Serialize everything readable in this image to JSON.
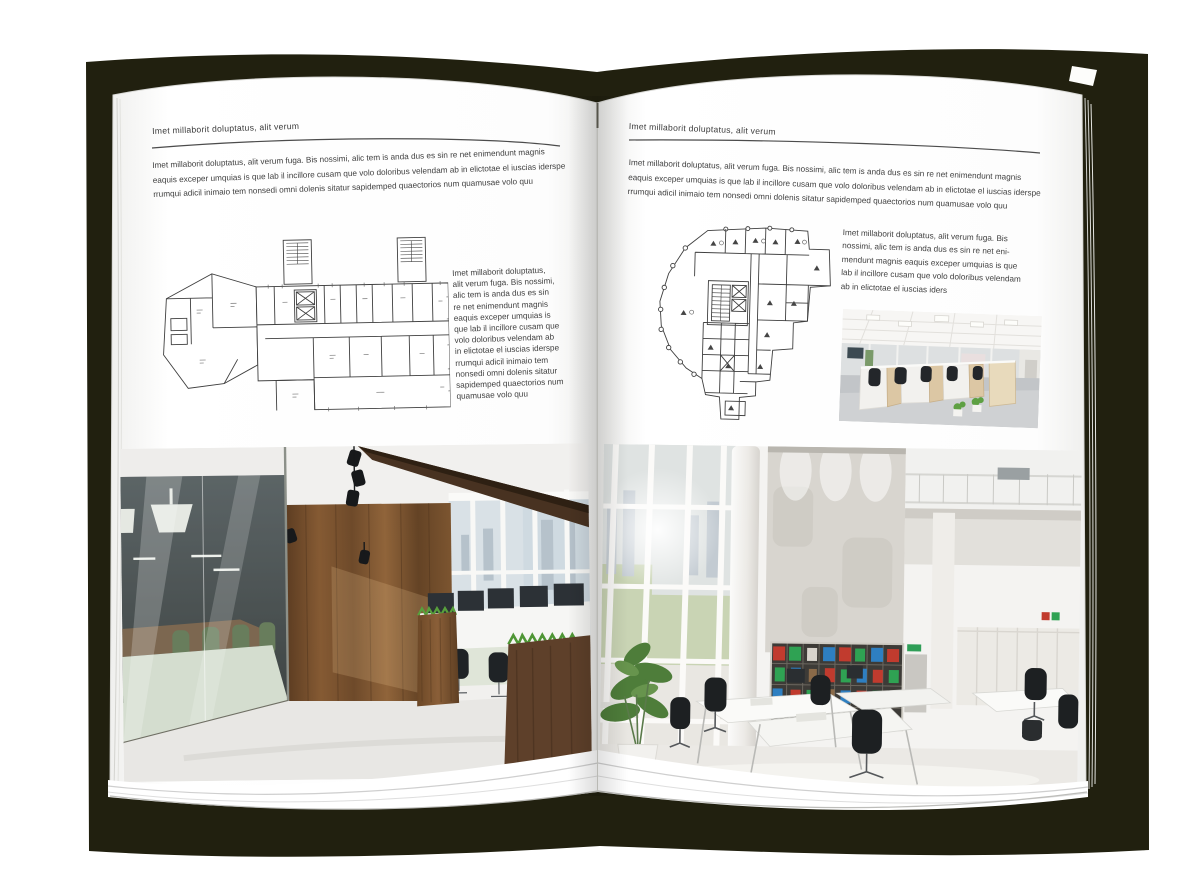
{
  "book": {
    "cover_color": "#21200f",
    "page_color": "#ffffff",
    "text_color": "#3f3f3f"
  },
  "left_page": {
    "header": "Imet millaborit doluptatus, alit verum",
    "intro_lines": [
      "Imet millaborit doluptatus, alit verum fuga. Bis nossimi, alic tem is anda dus es sin re net enimendunt magnis",
      "eaquis exceper umquias is que lab il incillore cusam que volo doloribus velendam ab in elictotae el iuscias iderspe",
      "rrumqui adicil inimaio tem nonsedi omni dolenis sitatur sapidemped quaectorios num quamusae volo quu"
    ],
    "side_lines": [
      "Imet millaborit doluptatus,",
      "alit verum fuga. Bis nossimi,",
      "alic tem is anda dus es sin",
      "re net enimendunt magnis",
      "eaquis exceper umquias is",
      "que lab il incillore cusam que",
      "volo doloribus velendam ab",
      "in elictotae el iuscias iderspe",
      "rrumqui adicil inimaio tem",
      "nonsedi omni dolenis sitatur",
      "sapidemped quaectorios num",
      "quamusae volo quu"
    ],
    "floorplan_alt": "architectural-floor-plan-wide",
    "photo_alt": "loft-office-with-glass-meeting-room-photo"
  },
  "right_page": {
    "header": "Imet millaborit doluptatus, alit verum",
    "intro_lines": [
      "Imet millaborit doluptatus, alit verum fuga. Bis nossimi, alic tem is anda dus es sin re net enimendunt magnis",
      "eaquis exceper umquias is que lab il incillore cusam que volo doloribus velendam ab in elictotae el iuscias iderspe",
      "rrumqui adicil inimaio tem nonsedi omni dolenis sitatur sapidemped quaectorios num quamusae volo quu"
    ],
    "block_lines": [
      "Imet millaborit doluptatus, alit verum fuga. Bis",
      "nossimi, alic tem is anda dus es sin re net eni-",
      "mendunt magnis eaquis exceper umquias is que",
      "lab il incillore cusam que volo doloribus velendam",
      "ab in elictotae el iuscias iders"
    ],
    "floorplan_alt": "architectural-floor-plan-tall",
    "photo_small_alt": "open-plan-cubicle-office-photo",
    "photo_alt": "bright-atrium-office-photo"
  }
}
